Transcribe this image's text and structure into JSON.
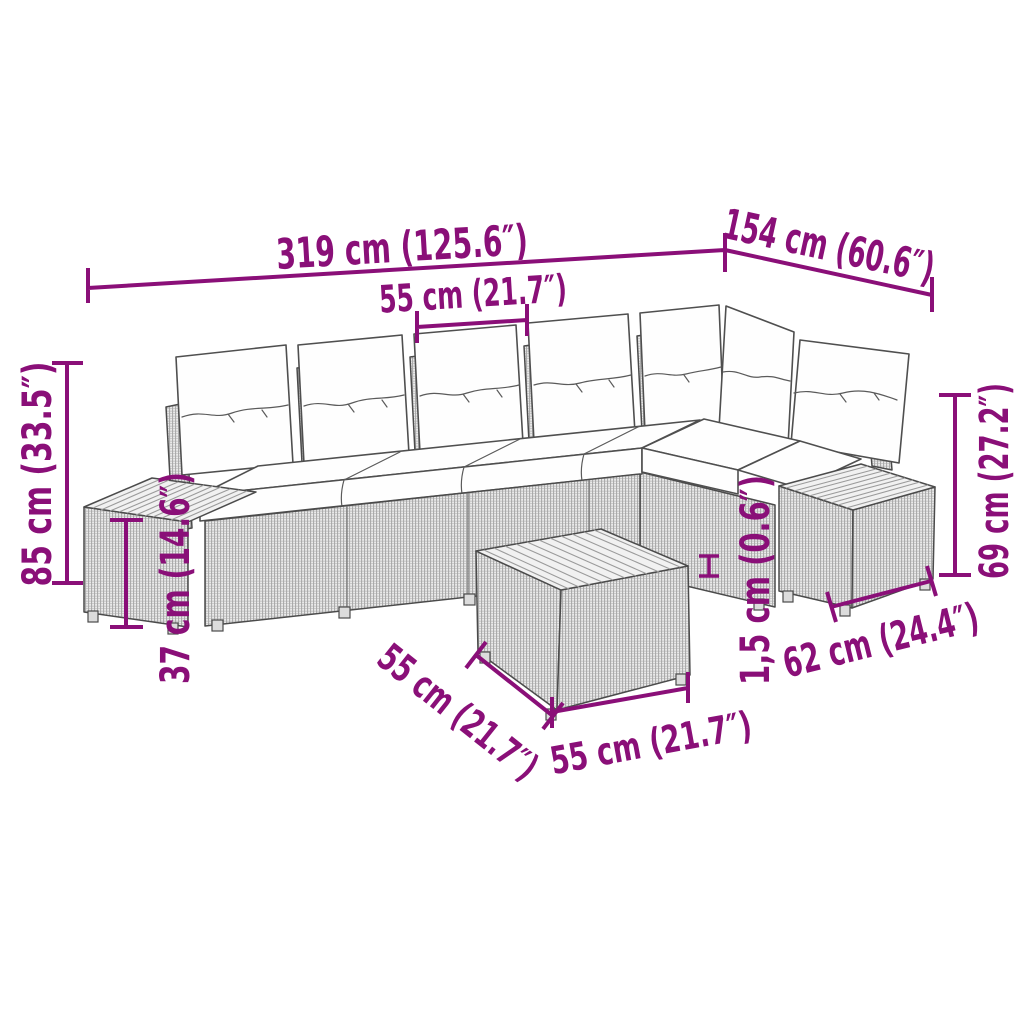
{
  "page": {
    "background": "#ffffff",
    "description": "Dimension diagram of an L-shaped poly rattan garden lounge set with white back and seat cushions, two wood-topped side tables and a square wood-topped coffee table"
  },
  "colors": {
    "dimension_accent": "#8A0F78",
    "line_art": "#4b4b4b",
    "rattan_fill": "#ebebeb",
    "wood_fill": "#f1f1f1",
    "cushion_fill": "#ffffff"
  },
  "dimensions": {
    "total_width": {
      "label": "319 cm (125.6″)",
      "cm": 319,
      "inches": 125.6
    },
    "side_depth": {
      "label": "154 cm (60.6″)",
      "cm": 154,
      "inches": 60.6
    },
    "seat_width": {
      "label": "55 cm (21.7″)",
      "cm": 55,
      "inches": 21.7
    },
    "overall_height": {
      "label": "85 cm (33.5″)",
      "cm": 85,
      "inches": 33.5
    },
    "seat_height": {
      "label": "37 cm (14.6″)",
      "cm": 37,
      "inches": 14.6
    },
    "side_section_height": {
      "label": "69 cm (27.2″)",
      "cm": 69,
      "inches": 27.2
    },
    "tabletop_thickness": {
      "label": "1,5 cm (0.6″)",
      "cm": 1.5,
      "inches": 0.6
    },
    "side_table_width": {
      "label": "62 cm (24.4″)",
      "cm": 62,
      "inches": 24.4
    },
    "coffee_table_depth": {
      "label": "55 cm (21.7″)",
      "cm": 55,
      "inches": 21.7
    },
    "coffee_table_width": {
      "label": "55 cm (21.7″)",
      "cm": 55,
      "inches": 21.7
    }
  }
}
